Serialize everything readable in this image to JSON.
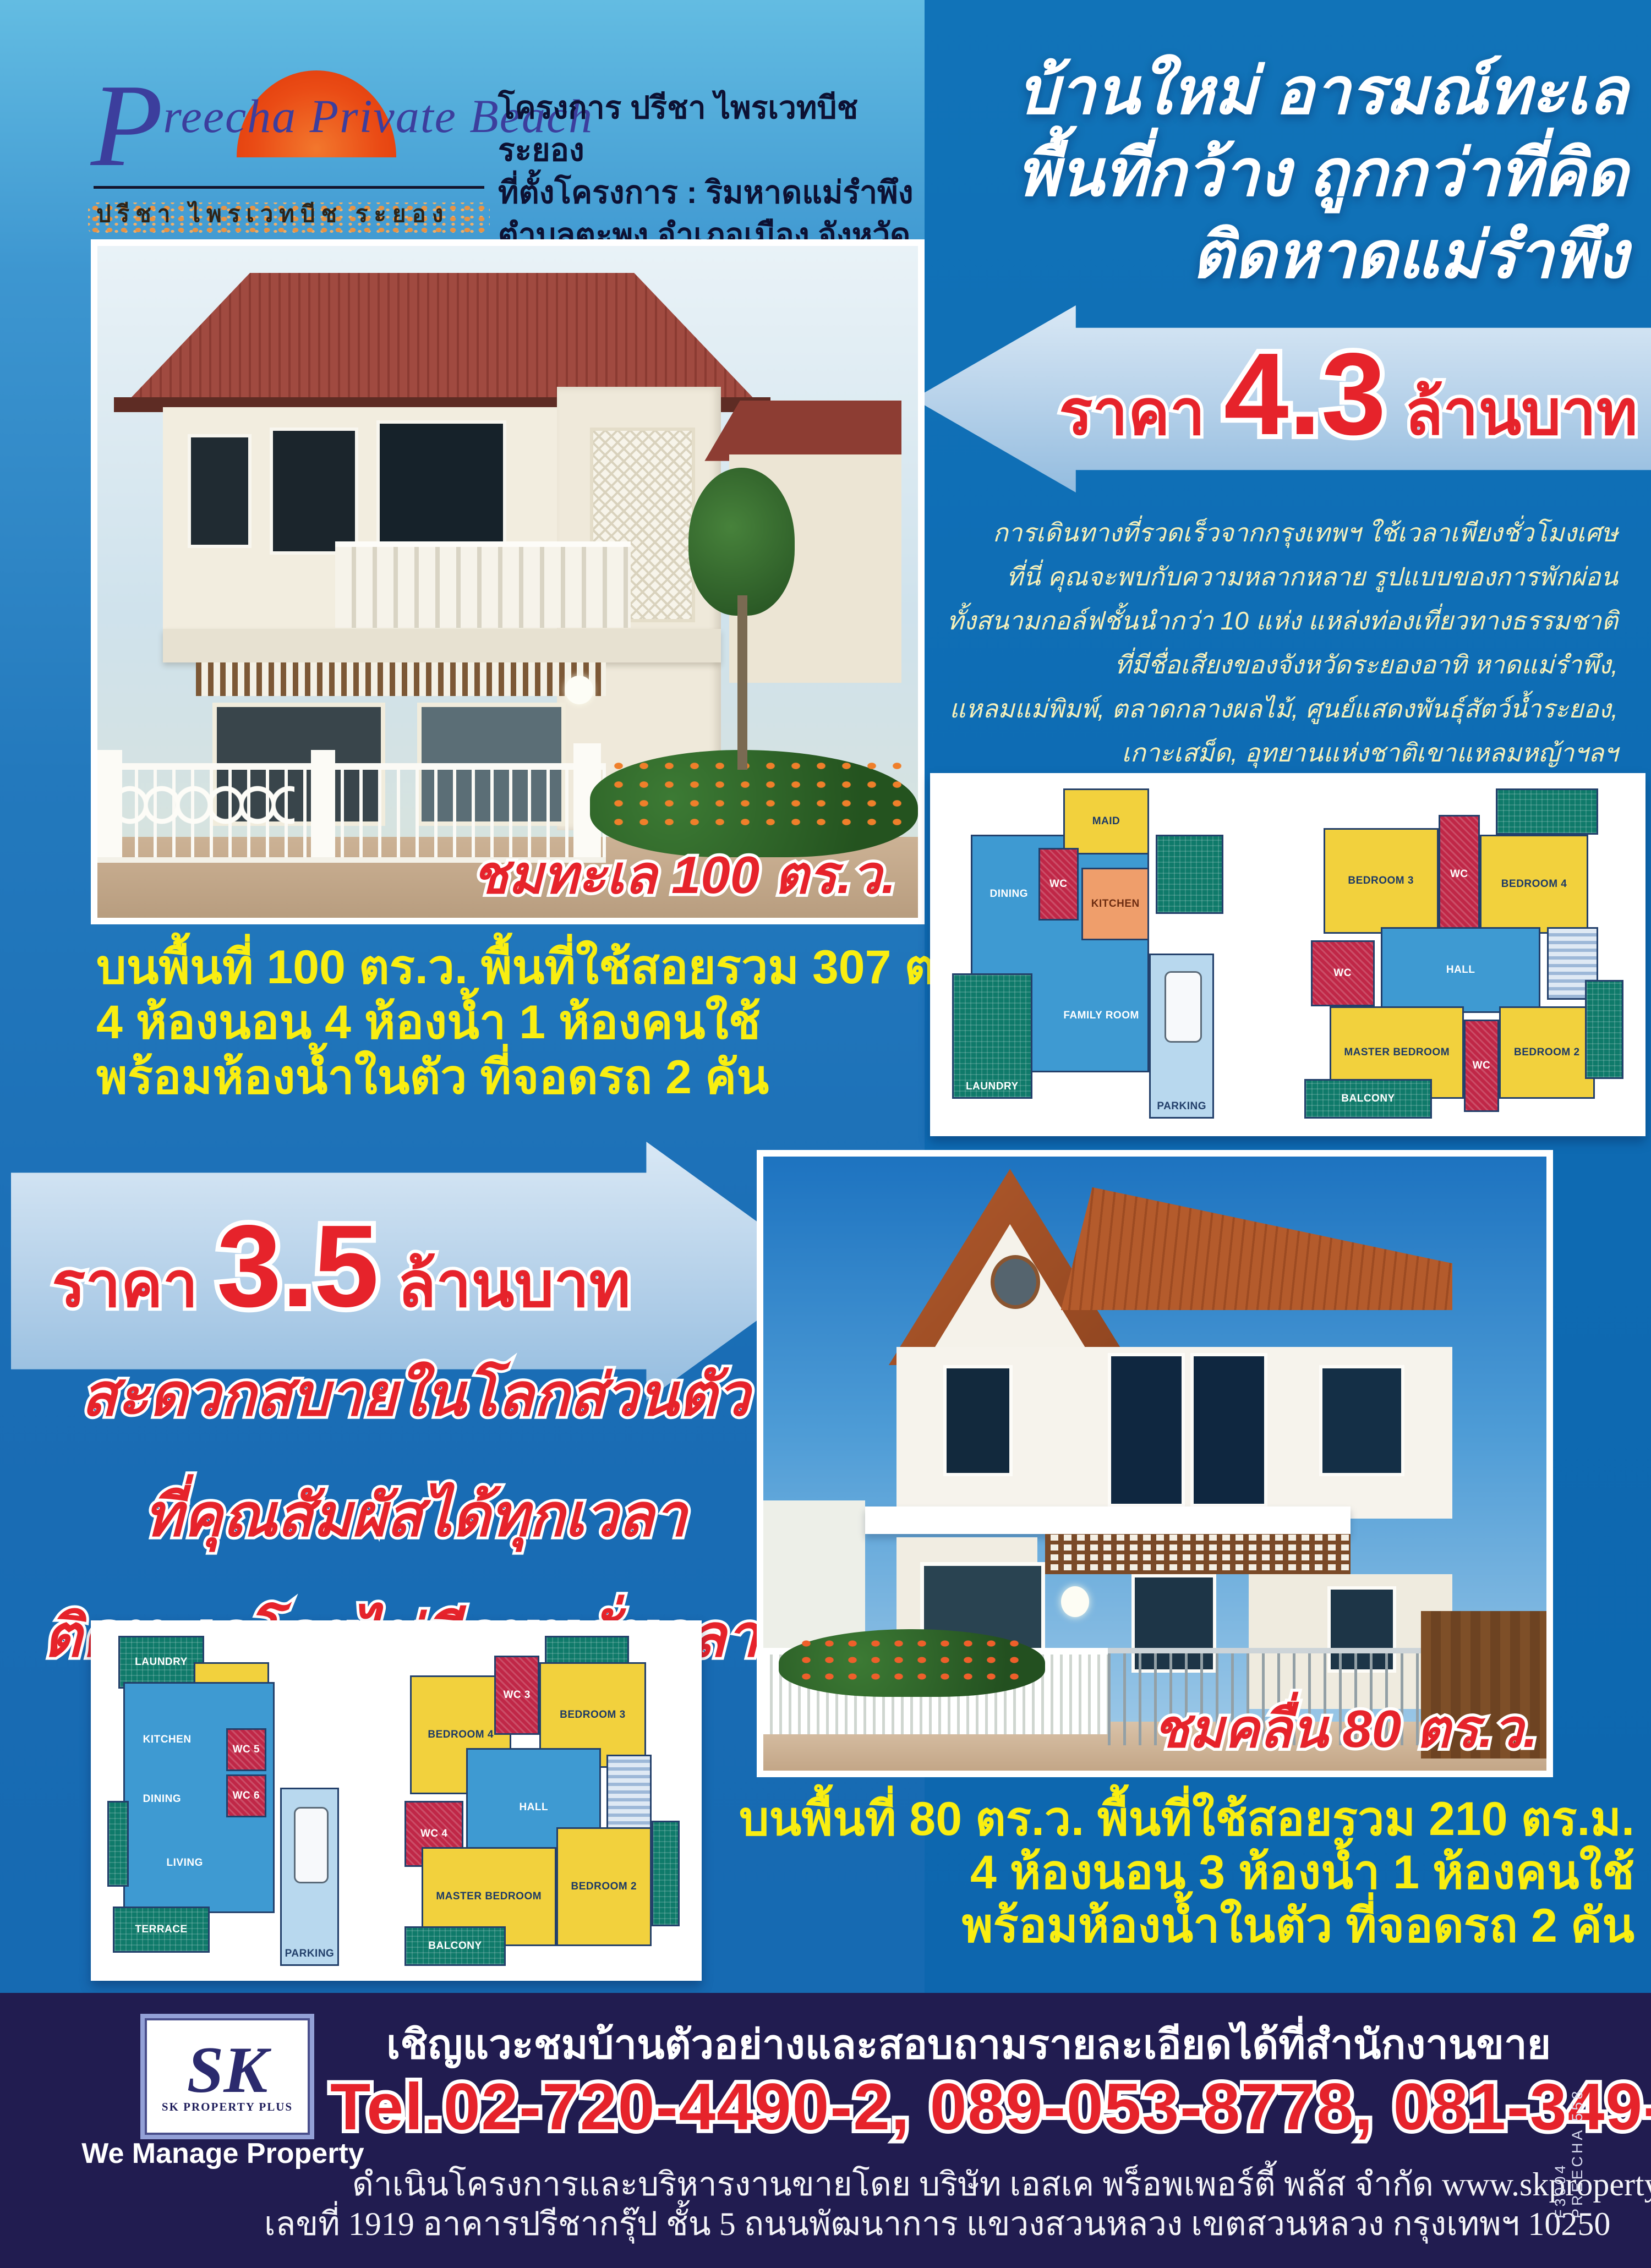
{
  "brand": {
    "logo_script": "Preecha Private Beach",
    "logo_p": "P",
    "logo_rest": "reecha Private Beach",
    "logo_thai": "ปรีชา ไพรเวทบีช ระยอง",
    "info_lines": [
      "โครงการ ปรีชา ไพรเวทบีช ระยอง",
      "ที่ตั้งโครงการ : ริมหาดแม่รำพึง",
      "ตำบลตะพง อำเภอเมือง จังหวัดระยอง"
    ]
  },
  "headline": {
    "lines": [
      "บ้านใหม่ อารมณ์ทะเล",
      "พื้นที่กว้าง ถูกกว่าที่คิด",
      "ติดหาดแม่รำพึง"
    ]
  },
  "price1": {
    "label": "ราคา",
    "value": "4.3",
    "unit": "ล้านบาท"
  },
  "price2": {
    "label": "ราคา",
    "value": "3.5",
    "unit": "ล้านบาท"
  },
  "intro": {
    "lines": [
      "การเดินทางที่รวดเร็วจากกรุงเทพฯ ใช้เวลาเพียงชั่วโมงเศษ",
      "ที่นี่ คุณจะพบกับความหลากหลาย รูปแบบของการพักผ่อน",
      "ทั้งสนามกอล์ฟชั้นนำกว่า 10 แห่ง แหล่งท่องเที่ยวทางธรรมชาติ",
      "ที่มีชื่อเสียงของจังหวัดระยองอาทิ หาดแม่รำพึง,",
      "แหลมแม่พิมพ์, ตลาดกลางผลไม้, ศูนย์แสดงพันธุ์สัตว์น้ำระยอง,",
      "เกาะเสม็ด, อุทยานแห่งชาติเขาแหลมหญ้าฯลฯ"
    ]
  },
  "house1": {
    "caption": "ชมทะเล 100 ตร.ว.",
    "specs": [
      "บนพื้นที่ 100 ตร.ว. พื้นที่ใช้สอยรวม 307 ตร.ม.",
      "4 ห้องนอน 4 ห้องน้ำ 1 ห้องคนใช้",
      "พร้อมห้องน้ำในตัว ที่จอดรถ 2 คัน"
    ]
  },
  "benefits": {
    "lines": [
      "สะดวกสบายในโลกส่วนตัว",
      "ที่คุณสัมผัสได้ทุกเวลา",
      "ติดทะเลโดยไม่มีถนนคั่นกลาง"
    ]
  },
  "house2": {
    "caption": "ชมคลื่น 80 ตร.ว.",
    "specs": [
      "บนพื้นที่ 80 ตร.ว. พื้นที่ใช้สอยรวม 210 ตร.ม.",
      "4 ห้องนอน 3 ห้องน้ำ 1 ห้องคนใช้",
      "พร้อมห้องน้ำในตัว ที่จอดรถ 2 คัน"
    ]
  },
  "floorplan1": {
    "ground": {
      "maid": "MAID",
      "wc": "WC",
      "kitchen": "KITCHEN",
      "dining": "DINING",
      "living": "LIVING",
      "family": "FAMILY ROOM",
      "laundry": "LAUNDRY",
      "parking": "PARKING"
    },
    "upper": {
      "bedroom3": "BEDROOM 3",
      "bedroom4": "BEDROOM 4",
      "wc_a": "WC",
      "wc_b": "WC",
      "wc_c": "WC",
      "hall": "HALL",
      "master": "MASTER BEDROOM",
      "bedroom2": "BEDROOM 2",
      "balcony": "BALCONY"
    }
  },
  "floorplan2": {
    "ground": {
      "laundry": "LAUNDRY",
      "maid": "MAID",
      "kitchen": "KITCHEN",
      "wc5": "WC 5",
      "wc6": "WC 6",
      "dining": "DINING",
      "living": "LIVING",
      "terrace": "TERRACE",
      "parking": "PARKING"
    },
    "upper": {
      "bedroom4": "BEDROOM 4",
      "wc3": "WC 3",
      "bedroom3": "BEDROOM 3",
      "wc4": "WC 4",
      "hall": "HALL",
      "master": "MASTER BEDROOM",
      "bedroom2": "BEDROOM 2",
      "balcony": "BALCONY"
    }
  },
  "footer": {
    "sk_monogram": "SK",
    "sk_label": "SK PROPERTY PLUS",
    "tagline": "We Manage Property",
    "headline": "เชิญแวะชมบ้านตัวอย่างและสอบถามรายละเอียดได้ที่สำนักงานขาย",
    "phone": "Tel.02-720-4490-2, 089-053-8778, 081-349-3983",
    "company_line": "ดำเนินโครงการและบริหารงานขายโดย บริษัท เอสเค พร็อพเพอร์ตี้ พลัส จำกัด www.skpropertyplus.com",
    "address_line": "เลขที่ 1919 อาคารปรีชากรุ๊ป ชั้น 5 ถนนพัฒนาการ แขวงสวนหลวง เขตสวนหลวง กรุงเทพฯ 10250",
    "side_code": "F3004 PREECHA 558"
  },
  "colors": {
    "accent_red": "#e6232b",
    "spec_yellow": "#f9ee11",
    "cream": "#f4f0bb",
    "right_panel_blue": "#0e6cb4",
    "footer_navy": "#211c50",
    "arrow_blue": "#b4d0e9"
  }
}
